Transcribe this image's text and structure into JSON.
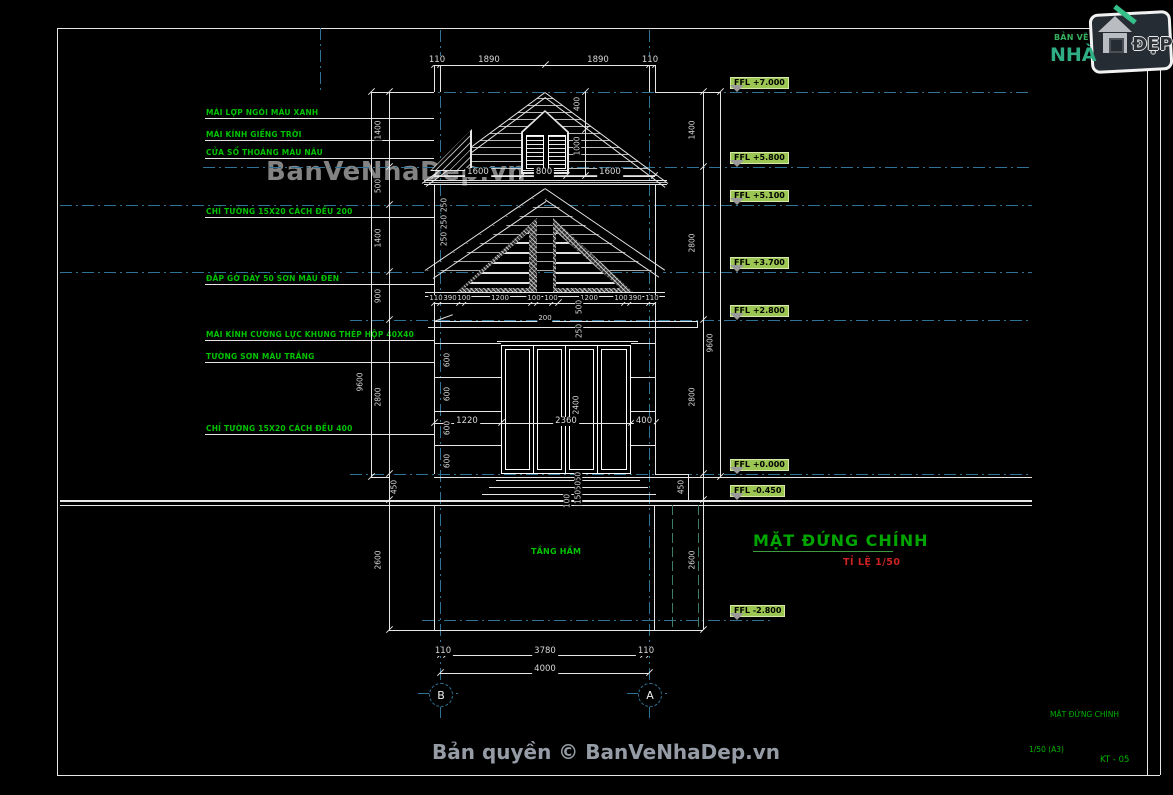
{
  "watermark": {
    "text": "BanVeNhaDep.vn"
  },
  "footer": {
    "copyright": "Bản quyền © BanVeNhaDep.vn"
  },
  "logo": {
    "top": "BẢN VẼ",
    "name": "NHÀ",
    "suffix": "ĐẸP"
  },
  "title": {
    "text": "MẶT ĐỨNG CHÍNH",
    "scale": "TỈ LỆ 1/50"
  },
  "titleblock": {
    "drawing_name": "MẶT ĐỨNG CHÍNH",
    "scale_sheet": "1/50  (A3)",
    "sheet_no": "KT - 05"
  },
  "labels": {
    "basement": "TẦNG HẦM"
  },
  "grid": {
    "left": "B",
    "right": "A"
  },
  "colors": {
    "callout_green": "#00c300",
    "marker_green": "#9cc653",
    "dash_blue": "#2f7294",
    "title_green": "#00a500",
    "scale_red": "#cc2222"
  },
  "callouts": [
    {
      "text": "MÁI LỢP NGÓI MÀU XANH"
    },
    {
      "text": "MÁI KÍNH GIẾNG TRỜI"
    },
    {
      "text": "CỬA SỔ THOÁNG MÀU NÂU"
    },
    {
      "text": "CHỈ TƯỜNG 15X20 CÁCH ĐỀU 200"
    },
    {
      "text": "ĐẮP GỜ DÀY 50 SƠN MÀU ĐEN"
    },
    {
      "text": "MÁI KÍNH CƯỜNG LỰC KHUNG THÉP HỘP 40X40"
    },
    {
      "text": "TƯỜNG SƠN MÀU TRẮNG"
    },
    {
      "text": "CHỈ TƯỜNG 15X20 CÁCH ĐỀU 400"
    }
  ],
  "levels": [
    {
      "label": "FFL +7.000"
    },
    {
      "label": "FFL +5.800"
    },
    {
      "label": "FFL +5.100"
    },
    {
      "label": "FFL +3.700"
    },
    {
      "label": "FFL +2.800"
    },
    {
      "label": "FFL +0.000"
    },
    {
      "label": "FFL -0.450"
    },
    {
      "label": "FFL -2.800"
    }
  ],
  "dims": {
    "top": [
      "110",
      "1890",
      "1890",
      "110"
    ],
    "roof_base": [
      "1600",
      "800",
      "1600"
    ],
    "gable": [
      "110",
      "390",
      "100",
      "1200",
      "100",
      "100",
      "1200",
      "100",
      "390",
      "110"
    ],
    "gable_center": "200",
    "door_row": [
      "1220",
      "2360",
      "400"
    ],
    "bottom_inner": [
      "110",
      "3780",
      "110"
    ],
    "bottom_total": "4000",
    "left_inner": [
      "1400",
      "500",
      "1400",
      "900",
      "2800",
      "450",
      "2600"
    ],
    "left_outer": "9600",
    "right_inner": [
      "1400",
      "2800",
      "2800",
      "450",
      "2600"
    ],
    "right_outer": "9600",
    "dormer": [
      "400",
      "1000"
    ],
    "center_small": [
      "500",
      "250",
      "2400",
      "150",
      "150",
      "150",
      "100"
    ],
    "wall_bands": [
      "600",
      "600",
      "600",
      "600"
    ],
    "cornice": [
      "250",
      "250",
      "250"
    ]
  }
}
